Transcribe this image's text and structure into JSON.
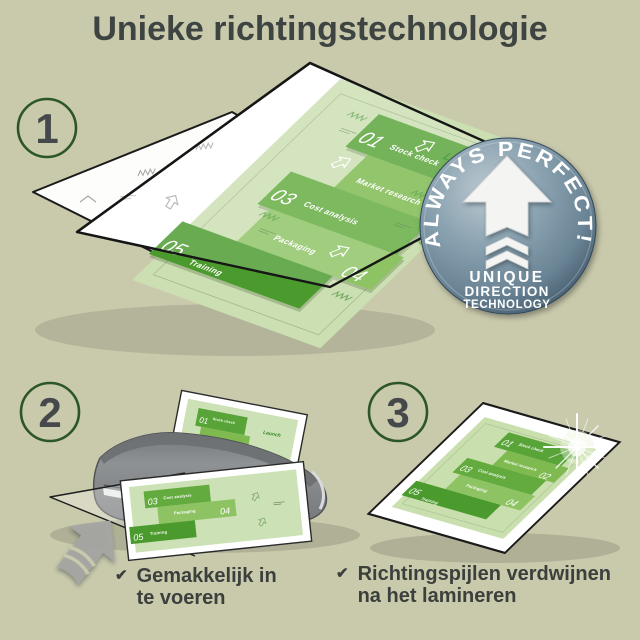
{
  "title": "Unieke richtingstechnologie",
  "step1": {
    "number": "1"
  },
  "step2": {
    "number": "2",
    "check": "✔",
    "caption_line1": "Gemakkelijk in",
    "caption_line2": "te voeren"
  },
  "step3": {
    "number": "3",
    "check": "✔",
    "caption_line1": "Richtingspijlen verdwijnen",
    "caption_line2": "na het lamineren"
  },
  "badge": {
    "arc_text": "ALWAYS PERFECT!",
    "line1": "UNIQUE",
    "line2": "DIRECTION",
    "line3": "TECHNOLOGY",
    "icon": "up-arrow-with-chevrons-icon"
  },
  "poster": {
    "launch_label": "Launch",
    "items": [
      {
        "num": "01",
        "label": "Stock check"
      },
      {
        "num": "02",
        "label": "Market research"
      },
      {
        "num": "03",
        "label": "Cost analysis"
      },
      {
        "num": "04",
        "label": "Packaging"
      },
      {
        "num": "05",
        "label": "Training"
      }
    ]
  },
  "colors": {
    "background": "#c9c9ac",
    "text": "#3e4441",
    "step_ring": "#2c5628",
    "green_dark": "#4b9a2e",
    "green_mid": "#63ab3e",
    "green_light": "#8ec364",
    "page_green": "#cde1b6",
    "badge_blue": "#7e97a6",
    "machine_gray": "#85888a"
  }
}
